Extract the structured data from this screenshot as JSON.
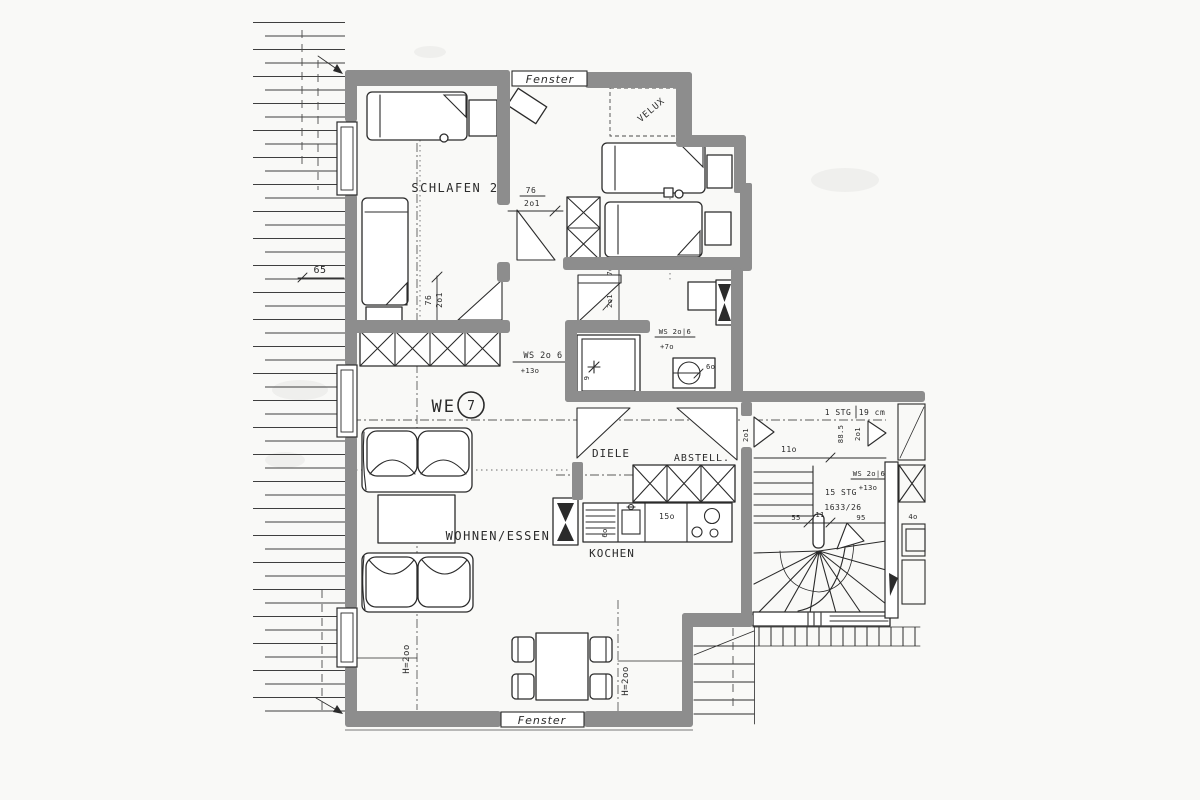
{
  "plan": {
    "unit_label": "WE",
    "unit_number": "7"
  },
  "labels": {
    "schlafen2": "SCHLAFEN 2",
    "bad": "BAD",
    "diele": "DIELE",
    "abstell": "ABSTELL.",
    "kochen": "KOCHEN",
    "wohnen_essen": "WOHNEN/ESSEN",
    "velux": "VELUX",
    "fenster_top": "Fenster",
    "fenster_bottom": "Fenster"
  },
  "dims": {
    "hatch_width": "65",
    "door_kids_w": "76",
    "door_kids_h": "2o1",
    "door_schlafen_w": "76",
    "door_schlafen_h": "2o1",
    "door_bad_w": "7o",
    "door_bad_h": "2o1",
    "wc_width": "6o",
    "shower_width": "9",
    "counter_length": "15o",
    "counter_depth": "6o",
    "entry_width": "11o",
    "entry_height": "2o1",
    "stair_55": "55",
    "stair_11": "11",
    "stair_95": "95",
    "neighbor_4o": "4o",
    "step_width": "88.5",
    "step_height": "2o1",
    "h200_left": "H=2oo",
    "h200_right": "H=2oo"
  },
  "annotations": {
    "ws_living": "WS 2o 6",
    "ws_living_plus": "+13o",
    "ws_bad": "WS 2o|6",
    "ws_bad_plus": "+7o",
    "ws_stair": "WS 2o|6",
    "ws_stair_plus": "+13o",
    "stg1": "1 STG",
    "stg1_cm": "19 cm",
    "stg15": "15 STG",
    "stg15_ratio": "1633/26"
  },
  "colors": {
    "wall": "#8d8d8d",
    "ink": "#2b2b2b",
    "paper": "#f9f9f7"
  }
}
